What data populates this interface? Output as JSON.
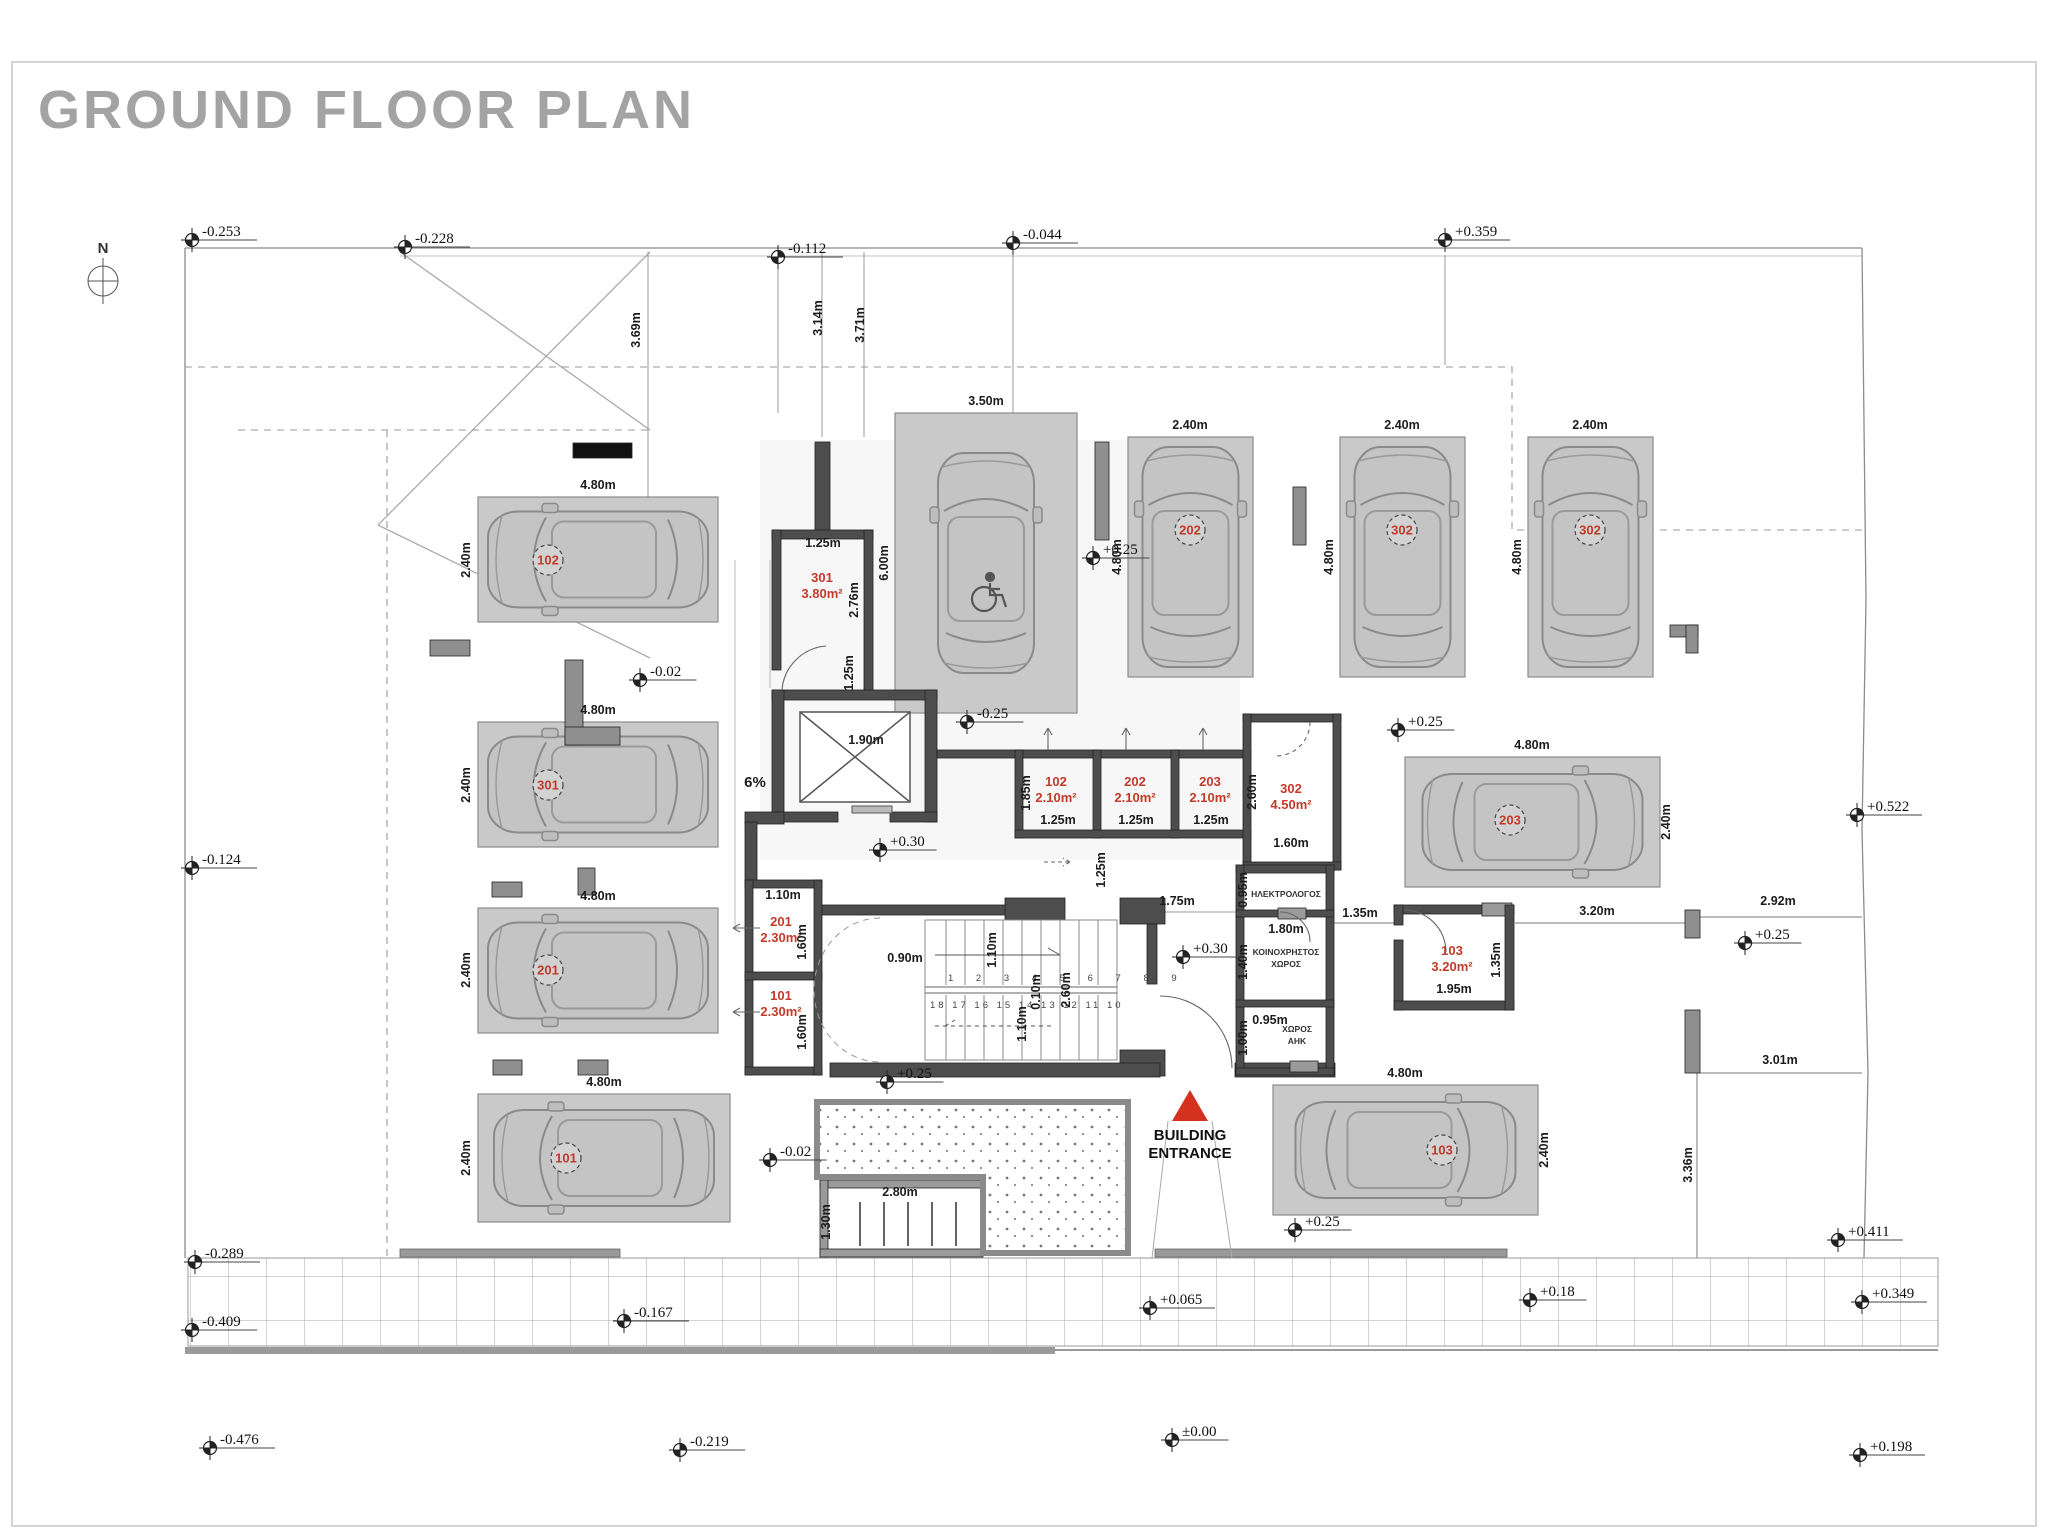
{
  "meta": {
    "title": "GROUND FLOOR PLAN",
    "north_label": "N"
  },
  "labels": {
    "ramp_slope": "6%"
  },
  "entrance": {
    "line1": "BUILDING",
    "line2": "ENTRANCE",
    "triangle_color": "#d4321e"
  },
  "stairs": {
    "top_numbers": "1 2 3 4 5 6 7 8 9",
    "bottom_numbers": "18 17 16 15 14 13 12 11 10"
  },
  "colors": {
    "accent_red": "#c23b2a",
    "parking_fill": "#c9c9c9",
    "wall": "#4d4d4d",
    "line": "#8c8c8c",
    "title_gray": "#a3a3a3"
  },
  "elevation_markers": [
    {
      "t": "-0.253",
      "x": 192,
      "y": 240
    },
    {
      "t": "-0.228",
      "x": 405,
      "y": 247
    },
    {
      "t": "-0.112",
      "x": 778,
      "y": 257
    },
    {
      "t": "-0.044",
      "x": 1013,
      "y": 243
    },
    {
      "t": "+0.359",
      "x": 1445,
      "y": 240
    },
    {
      "t": "-0.124",
      "x": 192,
      "y": 868
    },
    {
      "t": "-0.02",
      "x": 640,
      "y": 680
    },
    {
      "t": "-0.25",
      "x": 967,
      "y": 722
    },
    {
      "t": "+0.25",
      "x": 1093,
      "y": 558
    },
    {
      "t": "+0.25",
      "x": 1398,
      "y": 730
    },
    {
      "t": "+0.30",
      "x": 880,
      "y": 850
    },
    {
      "t": "+0.30",
      "x": 1183,
      "y": 957
    },
    {
      "t": "+0.25",
      "x": 887,
      "y": 1082
    },
    {
      "t": "-0.02",
      "x": 770,
      "y": 1160
    },
    {
      "t": "+0.25",
      "x": 1295,
      "y": 1230
    },
    {
      "t": "+0.522",
      "x": 1857,
      "y": 815
    },
    {
      "t": "+0.25",
      "x": 1745,
      "y": 943
    },
    {
      "t": "-0.289",
      "x": 195,
      "y": 1262
    },
    {
      "t": "-0.409",
      "x": 192,
      "y": 1330
    },
    {
      "t": "-0.167",
      "x": 624,
      "y": 1321
    },
    {
      "t": "+0.065",
      "x": 1150,
      "y": 1308
    },
    {
      "t": "+0.18",
      "x": 1530,
      "y": 1300
    },
    {
      "t": "+0.411",
      "x": 1838,
      "y": 1240
    },
    {
      "t": "+0.349",
      "x": 1862,
      "y": 1302
    },
    {
      "t": "-0.476",
      "x": 210,
      "y": 1448
    },
    {
      "t": "-0.219",
      "x": 680,
      "y": 1450
    },
    {
      "t": "±0.00",
      "x": 1172,
      "y": 1440
    },
    {
      "t": "+0.198",
      "x": 1860,
      "y": 1455
    }
  ],
  "parking_spots": [
    {
      "num": "102",
      "x": 478,
      "y": 497,
      "w": 240,
      "h": 125,
      "dir": "left",
      "cx": 548,
      "cy": 560
    },
    {
      "num": "301",
      "x": 478,
      "y": 722,
      "w": 240,
      "h": 125,
      "dir": "left",
      "cx": 548,
      "cy": 785
    },
    {
      "num": "201",
      "x": 478,
      "y": 908,
      "w": 240,
      "h": 125,
      "dir": "left",
      "cx": 548,
      "cy": 970
    },
    {
      "num": "101",
      "x": 478,
      "y": 1094,
      "w": 252,
      "h": 128,
      "dir": "left",
      "cx": 566,
      "cy": 1158
    },
    {
      "num": "",
      "x": 895,
      "y": 413,
      "w": 182,
      "h": 300,
      "dir": "up",
      "disabled": true
    },
    {
      "num": "202",
      "x": 1128,
      "y": 437,
      "w": 125,
      "h": 240,
      "dir": "up",
      "cx": 1190,
      "cy": 530
    },
    {
      "num": "302",
      "x": 1340,
      "y": 437,
      "w": 125,
      "h": 240,
      "dir": "up",
      "cx": 1402,
      "cy": 530
    },
    {
      "num": "302",
      "x": 1528,
      "y": 437,
      "w": 125,
      "h": 240,
      "dir": "up",
      "cx": 1590,
      "cy": 530
    },
    {
      "num": "203",
      "x": 1405,
      "y": 757,
      "w": 255,
      "h": 130,
      "dir": "right",
      "cx": 1510,
      "cy": 820
    },
    {
      "num": "103",
      "x": 1273,
      "y": 1085,
      "w": 265,
      "h": 130,
      "dir": "right",
      "cx": 1442,
      "cy": 1150
    }
  ],
  "storage_labels": [
    {
      "num": "301",
      "area": "3.80m²",
      "x": 822,
      "y": 582
    },
    {
      "num": "102",
      "area": "2.10m²",
      "x": 1056,
      "y": 786
    },
    {
      "num": "202",
      "area": "2.10m²",
      "x": 1135,
      "y": 786
    },
    {
      "num": "203",
      "area": "2.10m²",
      "x": 1210,
      "y": 786
    },
    {
      "num": "302",
      "area": "4.50m²",
      "x": 1291,
      "y": 793
    },
    {
      "num": "201",
      "area": "2.30m²",
      "x": 781,
      "y": 926
    },
    {
      "num": "101",
      "area": "2.30m²",
      "x": 781,
      "y": 1000
    },
    {
      "num": "103",
      "area": "3.20m²",
      "x": 1452,
      "y": 955
    }
  ],
  "room_labels": [
    {
      "lines": [
        "ΗΛΕΚΤΡΟΛΟΓΟΣ"
      ],
      "x": 1286,
      "y": 897
    },
    {
      "lines": [
        "ΚΟΙΝΟΧΡΗΣΤΟΣ",
        "ΧΩΡΟΣ"
      ],
      "x": 1286,
      "y": 955
    },
    {
      "lines": [
        "ΧΩΡΟΣ",
        "ΑΗΚ"
      ],
      "x": 1297,
      "y": 1032
    }
  ],
  "dimension_labels": [
    {
      "t": "3.69m",
      "x": 640,
      "y": 330,
      "r": -90
    },
    {
      "t": "3.14m",
      "x": 822,
      "y": 318,
      "r": -90
    },
    {
      "t": "3.71m",
      "x": 864,
      "y": 325,
      "r": -90
    },
    {
      "t": "4.80m",
      "x": 598,
      "y": 489
    },
    {
      "t": "2.40m",
      "x": 470,
      "y": 560,
      "r": -90
    },
    {
      "t": "4.80m",
      "x": 598,
      "y": 714
    },
    {
      "t": "2.40m",
      "x": 470,
      "y": 785,
      "r": -90
    },
    {
      "t": "4.80m",
      "x": 598,
      "y": 900
    },
    {
      "t": "2.40m",
      "x": 470,
      "y": 970,
      "r": -90
    },
    {
      "t": "4.80m",
      "x": 604,
      "y": 1086
    },
    {
      "t": "2.40m",
      "x": 470,
      "y": 1158,
      "r": -90
    },
    {
      "t": "3.50m",
      "x": 986,
      "y": 405
    },
    {
      "t": "6.00m",
      "x": 888,
      "y": 563,
      "r": -90
    },
    {
      "t": "2.40m",
      "x": 1190,
      "y": 429
    },
    {
      "t": "4.80m",
      "x": 1121,
      "y": 557,
      "r": -90
    },
    {
      "t": "2.40m",
      "x": 1402,
      "y": 429
    },
    {
      "t": "4.80m",
      "x": 1333,
      "y": 557,
      "r": -90
    },
    {
      "t": "2.40m",
      "x": 1590,
      "y": 429
    },
    {
      "t": "4.80m",
      "x": 1521,
      "y": 557,
      "r": -90
    },
    {
      "t": "4.80m",
      "x": 1532,
      "y": 749
    },
    {
      "t": "2.40m",
      "x": 1670,
      "y": 822,
      "r": -90
    },
    {
      "t": "4.80m",
      "x": 1405,
      "y": 1077
    },
    {
      "t": "2.40m",
      "x": 1548,
      "y": 1150,
      "r": -90
    },
    {
      "t": "1.25m",
      "x": 823,
      "y": 547
    },
    {
      "t": "2.76m",
      "x": 858,
      "y": 600,
      "r": -90
    },
    {
      "t": "1.90m",
      "x": 866,
      "y": 744
    },
    {
      "t": "1.85m",
      "x": 1030,
      "y": 793,
      "r": -90
    },
    {
      "t": "1.25m",
      "x": 1058,
      "y": 824
    },
    {
      "t": "1.25m",
      "x": 1136,
      "y": 824
    },
    {
      "t": "1.25m",
      "x": 1211,
      "y": 824
    },
    {
      "t": "2.60m",
      "x": 1256,
      "y": 792,
      "r": -90
    },
    {
      "t": "1.60m",
      "x": 1291,
      "y": 847
    },
    {
      "t": "1.10m",
      "x": 783,
      "y": 899
    },
    {
      "t": "1.60m",
      "x": 806,
      "y": 942,
      "r": -90
    },
    {
      "t": "1.60m",
      "x": 806,
      "y": 1032,
      "r": -90
    },
    {
      "t": "1.25m",
      "x": 853,
      "y": 673,
      "r": -90
    },
    {
      "t": "1.25m",
      "x": 1105,
      "y": 870,
      "r": -90
    },
    {
      "t": "1.75m",
      "x": 1177,
      "y": 905
    },
    {
      "t": "0.90m",
      "x": 905,
      "y": 962
    },
    {
      "t": "1.10m",
      "x": 996,
      "y": 950,
      "r": -90
    },
    {
      "t": "0.10m",
      "x": 1040,
      "y": 992,
      "r": -90
    },
    {
      "t": "1.10m",
      "x": 1026,
      "y": 1024,
      "r": -90
    },
    {
      "t": "2.60m",
      "x": 1070,
      "y": 990,
      "r": -90
    },
    {
      "t": "0.95m",
      "x": 1247,
      "y": 890,
      "r": -90
    },
    {
      "t": "1.80m",
      "x": 1286,
      "y": 933
    },
    {
      "t": "1.40m",
      "x": 1247,
      "y": 962,
      "r": -90
    },
    {
      "t": "0.95m",
      "x": 1270,
      "y": 1024
    },
    {
      "t": "1.00m",
      "x": 1247,
      "y": 1038,
      "r": -90
    },
    {
      "t": "1.35m",
      "x": 1360,
      "y": 917
    },
    {
      "t": "1.35m",
      "x": 1500,
      "y": 960,
      "r": -90
    },
    {
      "t": "1.95m",
      "x": 1454,
      "y": 993
    },
    {
      "t": "3.20m",
      "x": 1597,
      "y": 915
    },
    {
      "t": "2.92m",
      "x": 1778,
      "y": 905
    },
    {
      "t": "3.01m",
      "x": 1780,
      "y": 1064
    },
    {
      "t": "3.36m",
      "x": 1692,
      "y": 1165,
      "r": -90
    },
    {
      "t": "2.80m",
      "x": 900,
      "y": 1196
    },
    {
      "t": "1.30m",
      "x": 830,
      "y": 1222,
      "r": -90
    }
  ]
}
